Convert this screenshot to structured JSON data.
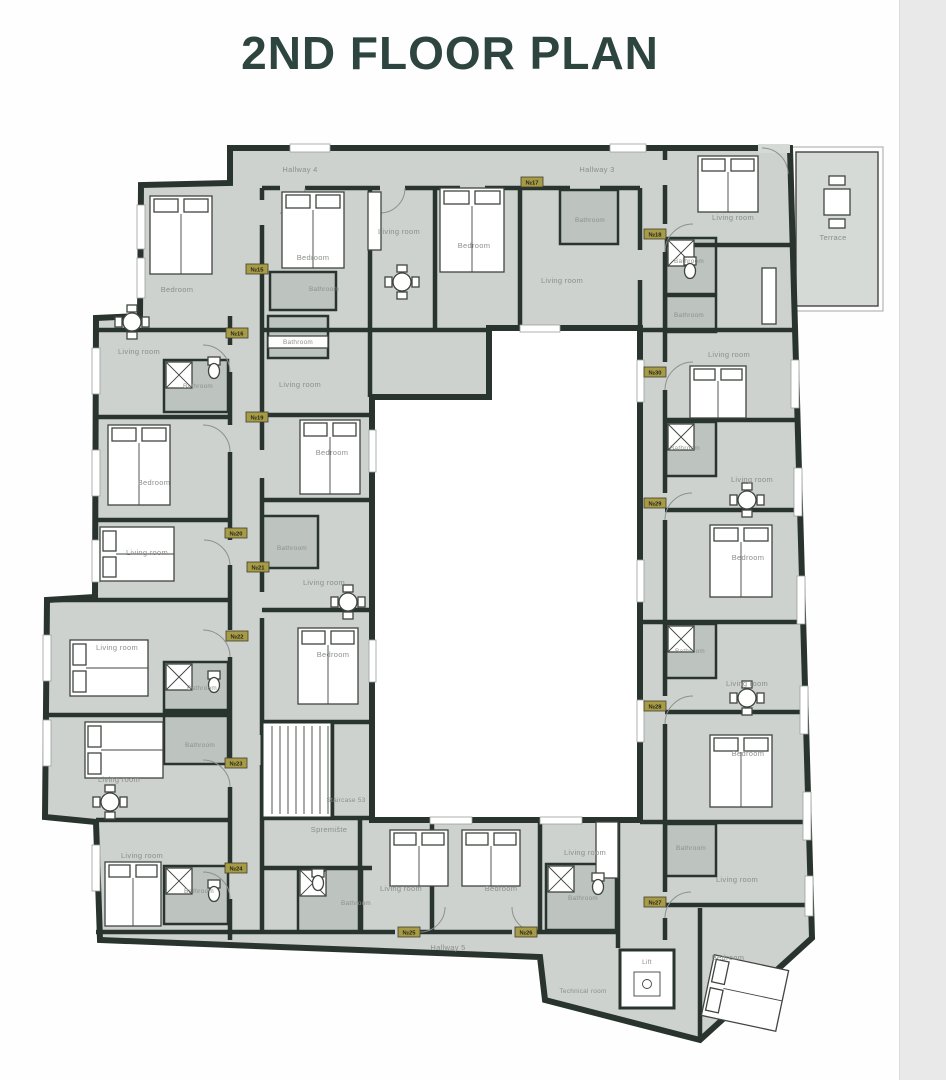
{
  "title": "2ND FLOOR PLAN",
  "colors": {
    "wall": "#2a342f",
    "floor": "#cdd2ce",
    "bathroom_floor": "#bdc4c0",
    "courtyard": "#ffffff",
    "terrace_floor": "#d5dad7",
    "badge": "#a89b45",
    "title_text": "#2d453e",
    "label_text": "#8b8f8b"
  },
  "rooms": [
    {
      "label": "Hallway 4"
    },
    {
      "label": "Hallway 3"
    },
    {
      "label": "Bedroom"
    },
    {
      "label": "Bathroom"
    },
    {
      "label": "Bathroom"
    },
    {
      "label": "Living room"
    },
    {
      "label": "Bedroom"
    },
    {
      "label": "Bathroom"
    },
    {
      "label": "Living room"
    },
    {
      "label": "Living room"
    },
    {
      "label": "Terrace"
    },
    {
      "label": "Bathroom"
    },
    {
      "label": "Bathroom"
    },
    {
      "label": "Living room"
    },
    {
      "label": "Bathroom"
    },
    {
      "label": "Living room"
    },
    {
      "label": "Bedroom"
    },
    {
      "label": "Bathroom"
    },
    {
      "label": "Living room"
    },
    {
      "label": "Bedroom"
    },
    {
      "label": "Bathroom"
    },
    {
      "label": "Living room"
    },
    {
      "label": "Bedroom"
    },
    {
      "label": "Lift"
    },
    {
      "label": "Technical room"
    },
    {
      "label": "Bedroom"
    },
    {
      "label": "Living room"
    },
    {
      "label": "Bathroom"
    },
    {
      "label": "Bedroom"
    },
    {
      "label": "Living room"
    },
    {
      "label": "Living room"
    },
    {
      "label": "Bathroom"
    },
    {
      "label": "Bathroom"
    },
    {
      "label": "Living room"
    },
    {
      "label": "Living room"
    },
    {
      "label": "Bathroom"
    },
    {
      "label": "Living room"
    },
    {
      "label": "Bedroom"
    },
    {
      "label": "Bathroom"
    },
    {
      "label": "Living room"
    },
    {
      "label": "Bedroom"
    },
    {
      "label": "Staircase 53"
    },
    {
      "label": "Spremište"
    },
    {
      "label": "Bathroom"
    },
    {
      "label": "Living room"
    },
    {
      "label": "Bedroom"
    },
    {
      "label": "Living room"
    },
    {
      "label": "Bathroom"
    },
    {
      "label": "Hallway 5"
    }
  ],
  "badges": [
    "№15",
    "№16",
    "№17",
    "№18",
    "№19",
    "№20",
    "№21",
    "№22",
    "№23",
    "№24",
    "№25",
    "№26",
    "№27",
    "№28",
    "№29",
    "№30"
  ]
}
